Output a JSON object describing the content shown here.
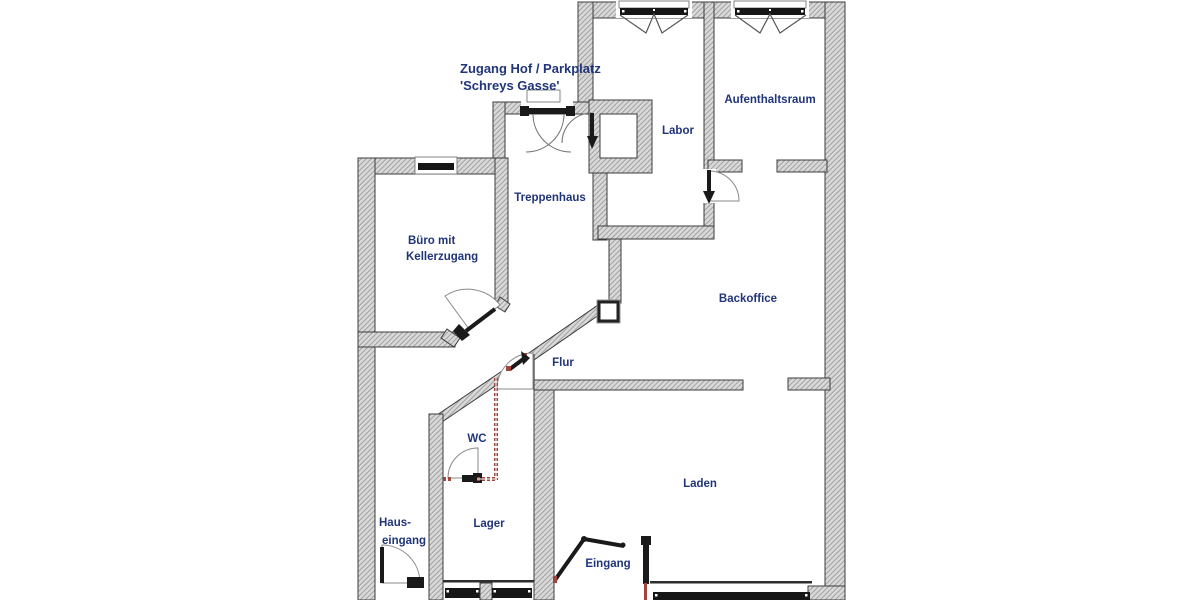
{
  "annotations": {
    "access_line1": "Zugang Hof / Parkplatz",
    "access_line2": "'Schreys Gasse'"
  },
  "rooms": {
    "aufenthaltsraum": "Aufenthaltsraum",
    "labor": "Labor",
    "treppenhaus": "Treppenhaus",
    "buero_line1": "Büro mit",
    "buero_line2": "Kellerzugang",
    "backoffice": "Backoffice",
    "flur": "Flur",
    "wc": "WC",
    "laden": "Laden",
    "lager": "Lager",
    "hauseingang_line1": "Haus-",
    "hauseingang_line2": "eingang",
    "eingang": "Eingang"
  },
  "colors": {
    "label": "#20357a",
    "wall_fill": "#d9d9d9",
    "wall_hatch": "#a3a3a3",
    "wall_outline": "#3c3c3c",
    "door_dark": "#1a1a1a",
    "partition_red": "#a0453c",
    "glass_dark": "#161616"
  }
}
